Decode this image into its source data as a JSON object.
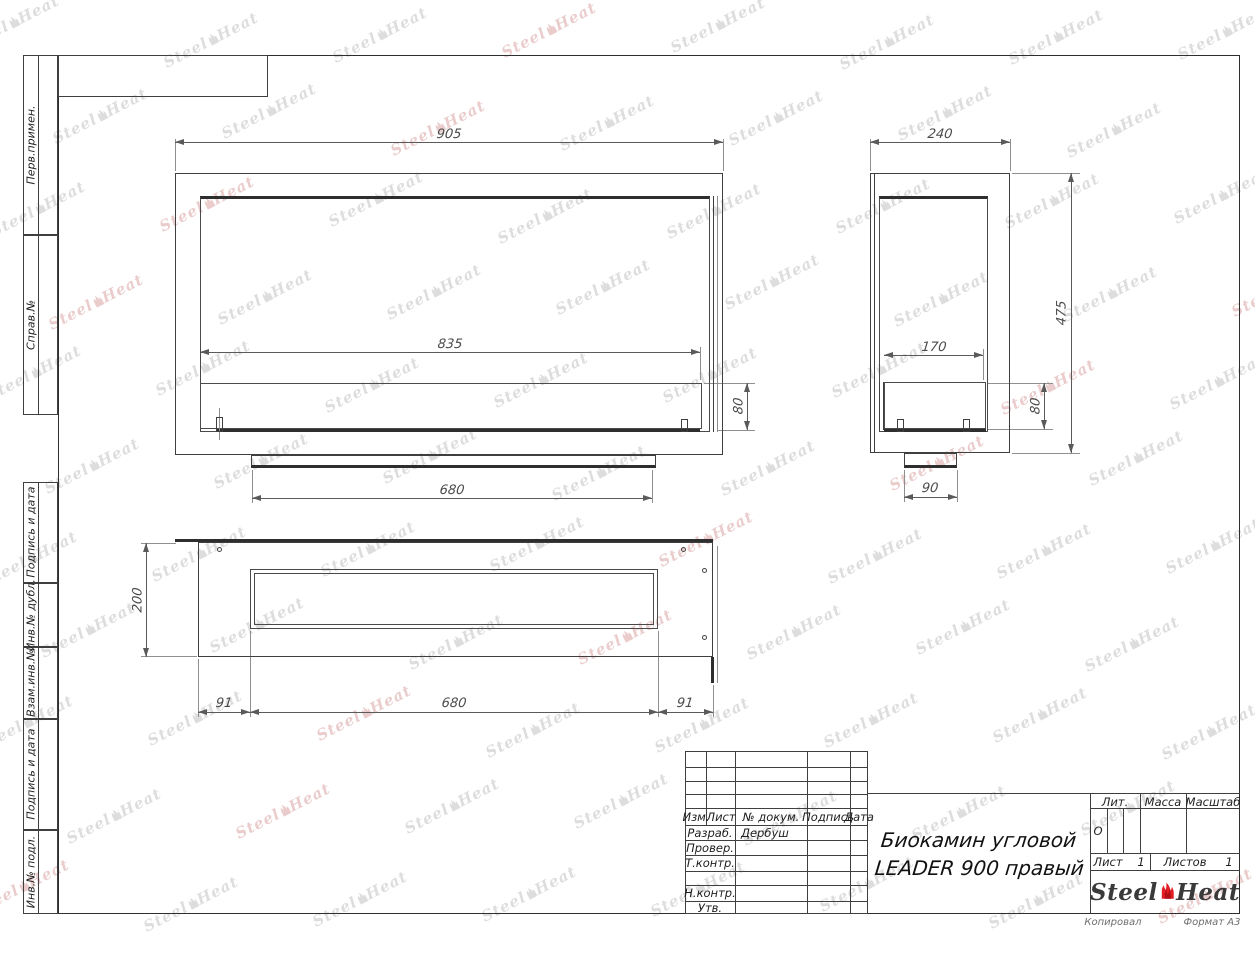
{
  "sheet": {
    "copied_note": "Копировал",
    "format_note": "Формат А3"
  },
  "margin_labels": [
    "Перв.примен.",
    "Справ.№",
    "Подпись и дата",
    "Инв.№ дубл.",
    "Взам.инв.№",
    "Подпись и дата",
    "Инв.№ подл."
  ],
  "title_block": {
    "headers": {
      "izm": "Изм.",
      "list": "Лист",
      "doc": "№ докум.",
      "podpis": "Подпись",
      "data": "Дата"
    },
    "rows": {
      "razrab": "Разраб.",
      "prover": "Провер.",
      "tkontr": "Т.контр.",
      "nkontr": "Н.контр.",
      "utv": "Утв."
    },
    "developer_name": "Дербуш",
    "doc_title_line1": "Биокамин угловой",
    "doc_title_line2": "LEADER 900 правый",
    "lit_label": "Лит.",
    "lit_value": "О",
    "mass_label": "Масса",
    "scale_label": "Масштаб",
    "sheet_label": "Лист",
    "sheet_value": "1",
    "sheets_label": "Листов",
    "sheets_value": "1"
  },
  "logo": {
    "steel": "Steel",
    "heat": "Heat",
    "flame_color": "#e31e24",
    "text_color": "#3a3a3a"
  },
  "watermark": {
    "steel": "Steel",
    "heat": "Heat",
    "color": "#c7c7c7",
    "accent_color": "#ddabab"
  },
  "views": {
    "front": {
      "overall_width": "905",
      "burner_width": "835",
      "burner_height": "80",
      "base_width": "680"
    },
    "side": {
      "overall_depth": "240",
      "overall_height": "475",
      "burner_depth": "170",
      "burner_height": "80",
      "foot_width": "90"
    },
    "top": {
      "depth": "200",
      "offset_left": "91",
      "opening_width": "680",
      "offset_right": "91"
    }
  },
  "colors": {
    "line": "#3f3f3f",
    "dim": "#5a5a5a",
    "ext": "#8f8f8f"
  }
}
